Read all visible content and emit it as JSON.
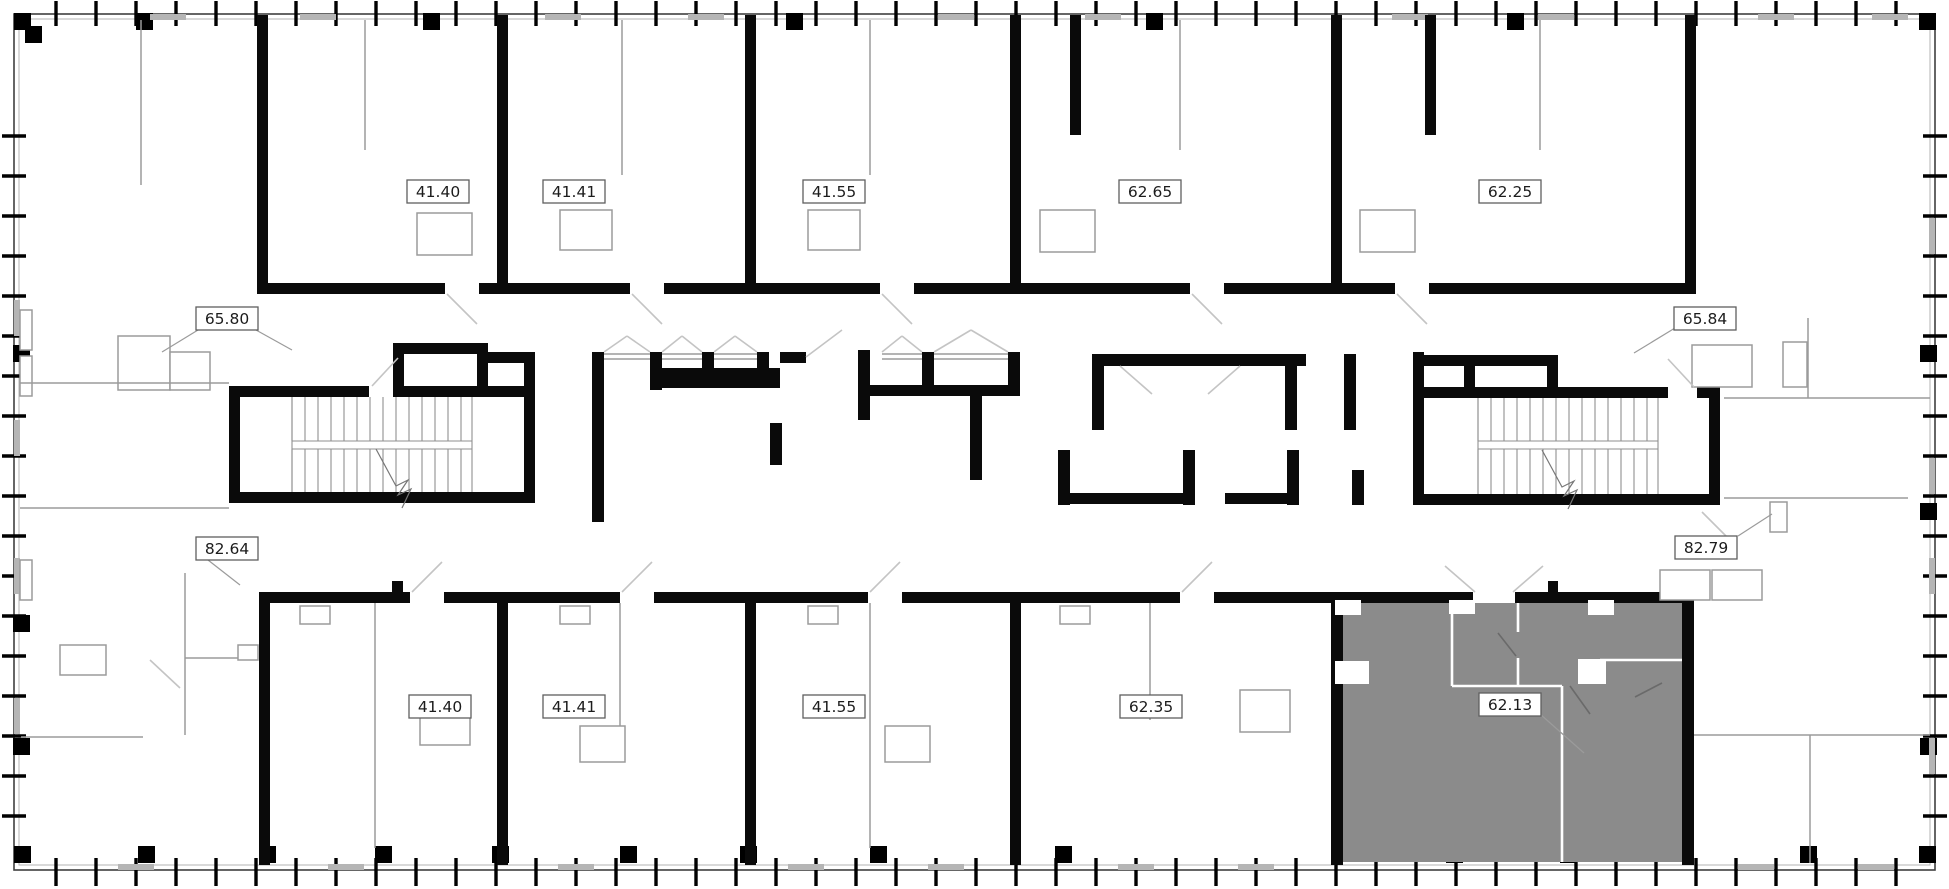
{
  "floorplan": {
    "description": "residential-floor-plan",
    "highlighted_unit": {
      "area": "62.13"
    },
    "colors": {
      "wall": "#0a0a0a",
      "thin_line": "#9b9b9b",
      "swing_line": "#c4c4c4",
      "window": "#b5b5b5",
      "highlight_fill": "#8b8b8b",
      "label_border": "#5f5f5f",
      "label_text": "#1c1c1c",
      "background": "#ffffff"
    },
    "labels": [
      {
        "id": "top-1",
        "area": "41.40"
      },
      {
        "id": "top-2",
        "area": "41.41"
      },
      {
        "id": "top-3",
        "area": "41.55"
      },
      {
        "id": "top-4",
        "area": "62.65"
      },
      {
        "id": "top-5",
        "area": "62.25"
      },
      {
        "id": "upper-left",
        "area": "65.80"
      },
      {
        "id": "upper-right",
        "area": "65.84"
      },
      {
        "id": "lower-left",
        "area": "82.64"
      },
      {
        "id": "lower-right",
        "area": "82.79"
      },
      {
        "id": "bottom-1",
        "area": "41.40"
      },
      {
        "id": "bottom-2",
        "area": "41.41"
      },
      {
        "id": "bottom-3",
        "area": "41.55"
      },
      {
        "id": "bottom-4",
        "area": "62.35"
      },
      {
        "id": "bottom-5",
        "area": "62.13",
        "highlighted": true
      }
    ]
  }
}
